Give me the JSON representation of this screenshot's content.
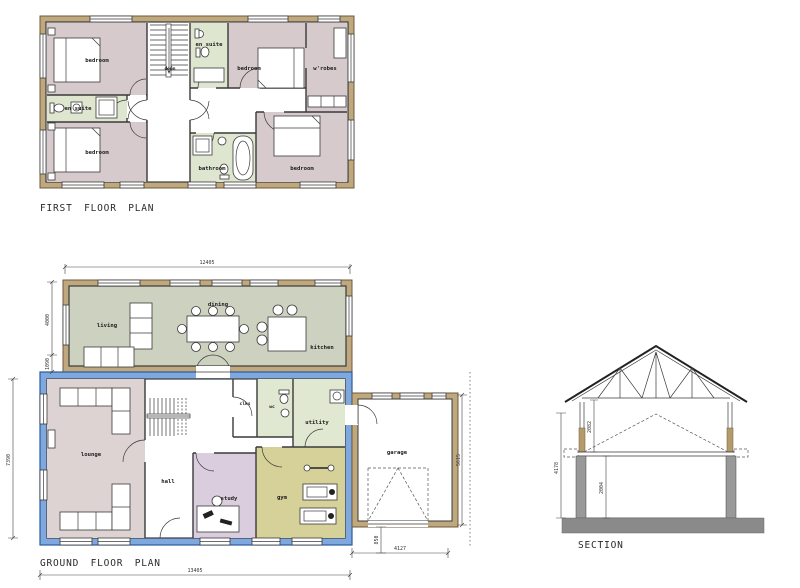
{
  "drawing": {
    "first_floor": {
      "title": "FIRST FLOOR PLAN",
      "labels": {
        "bedroom_tl": "bedroom",
        "bedroom_tr": "bedroom",
        "bedroom_bl": "bedroom",
        "bedroom_br": "bedroom",
        "ensuite_top": "en suite",
        "ensuite_left": "en suite",
        "bathroom": "bathroom",
        "wardrobe": "w'robes",
        "stairs_down": "down"
      }
    },
    "ground_floor": {
      "title": "GROUND FLOOR PLAN",
      "labels": {
        "living": "living",
        "dining": "dining",
        "kitchen": "kitchen",
        "lounge": "lounge",
        "hall": "hall",
        "clks": "clks",
        "wc": "wc",
        "utility": "utility",
        "study": "study",
        "gym": "gym",
        "garage": "garage"
      },
      "dimensions": {
        "overall_width": "12405",
        "living_depth": "4000",
        "bay_offset": "1090",
        "overall_depth": "7390",
        "total_width": "13405",
        "garage_width": "4127",
        "garage_depth": "5615",
        "garage_door_offset": "850"
      }
    },
    "section": {
      "title": "SECTION",
      "dimensions": {
        "overall_height": "4178",
        "first_floor_height": "2082",
        "ground_floor_height": "2004"
      }
    },
    "colors": {
      "wall_brown_fill": "#bfa87e",
      "wall_brown_line": "#6f5a3c",
      "wall_blue_fill": "#7fa9de",
      "wall_blue_line": "#2a5a9e",
      "bedroom_fill": "#d6cacd",
      "ensuite_fill": "#dee6cf",
      "living_fill": "#cdd1bf",
      "lounge_fill": "#ded3d3",
      "study_fill": "#dacede",
      "gym_fill": "#d6d099",
      "utility_fill": "#e0e8d2",
      "foundation_gray": "#8a8a8a"
    }
  }
}
